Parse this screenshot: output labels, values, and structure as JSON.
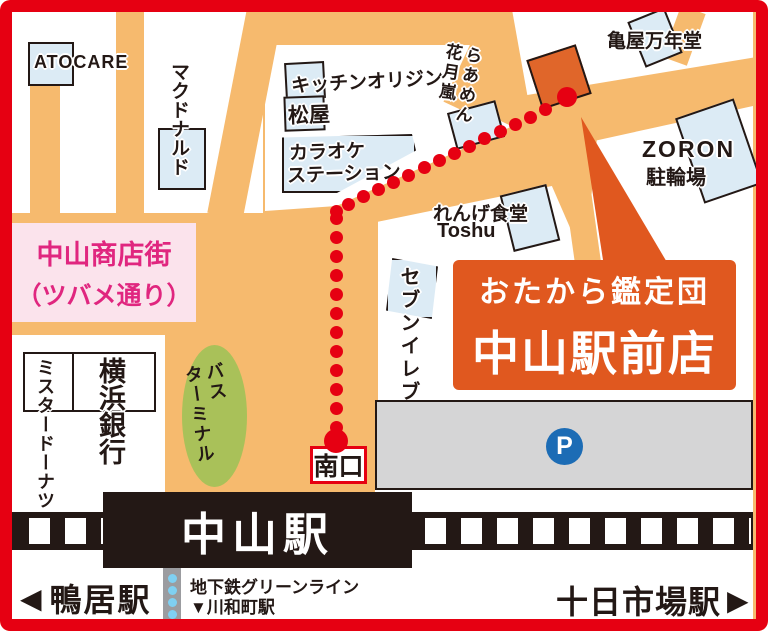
{
  "landmarks": {
    "atocare": {
      "label": "ATOCARE"
    },
    "mcdonalds": {
      "label": "マクドナルド"
    },
    "kitchen_origin": {
      "label": "キッチンオリジン"
    },
    "matsuya": {
      "label": "松屋"
    },
    "karaoke": {
      "line1": "カラオケ",
      "line2": "ステーション"
    },
    "ramen_kagetsu": {
      "col_right": "らあめん",
      "col_left": "花月嵐"
    },
    "kameya": {
      "label": "亀屋万年堂"
    },
    "zoron": {
      "line1": "ZORON",
      "line2": "駐輪場"
    },
    "renge": {
      "line1": "れんげ食堂",
      "line2": "Toshu"
    },
    "seven_eleven": {
      "label": "セブンイレブン"
    },
    "shotengai": {
      "line1": "中山商店街",
      "line2": "（ツバメ通り）"
    },
    "mister_donut": {
      "label": "ミスタードーナツ"
    },
    "yokohama_bank": {
      "label": "横浜銀行"
    },
    "bus_terminal": {
      "col_right": "バス",
      "col_left": "ターミナル"
    },
    "parking": {
      "label": "P"
    }
  },
  "store_callout": {
    "line1": "おたから鑑定団",
    "line2": "中山駅前店"
  },
  "station": {
    "name": "中山駅",
    "south_exit": "南口"
  },
  "bottom_bar": {
    "left_arrow": "◀",
    "left_station": "鴨居駅",
    "subway_line": "地下鉄グリーンライン",
    "subway_branch": "▼川和町駅",
    "right_station": "十日市場駅",
    "right_arrow": "▶"
  },
  "colors": {
    "frame_red": "#e60012",
    "road_orange": "#f6ba6e",
    "store_orange": "#e0581f",
    "marker_orange": "#e0662a",
    "building_blue": "#dcebf5",
    "pink_bg": "#fbe3ec",
    "pink_text": "#e0267f",
    "green": "#a9c159",
    "parking_blue": "#1c6cb5",
    "rail_black": "#231815",
    "parking_gray": "#d5d5d6",
    "subway_gray": "#9b9ca0",
    "subway_dot": "#7fd0f2"
  }
}
